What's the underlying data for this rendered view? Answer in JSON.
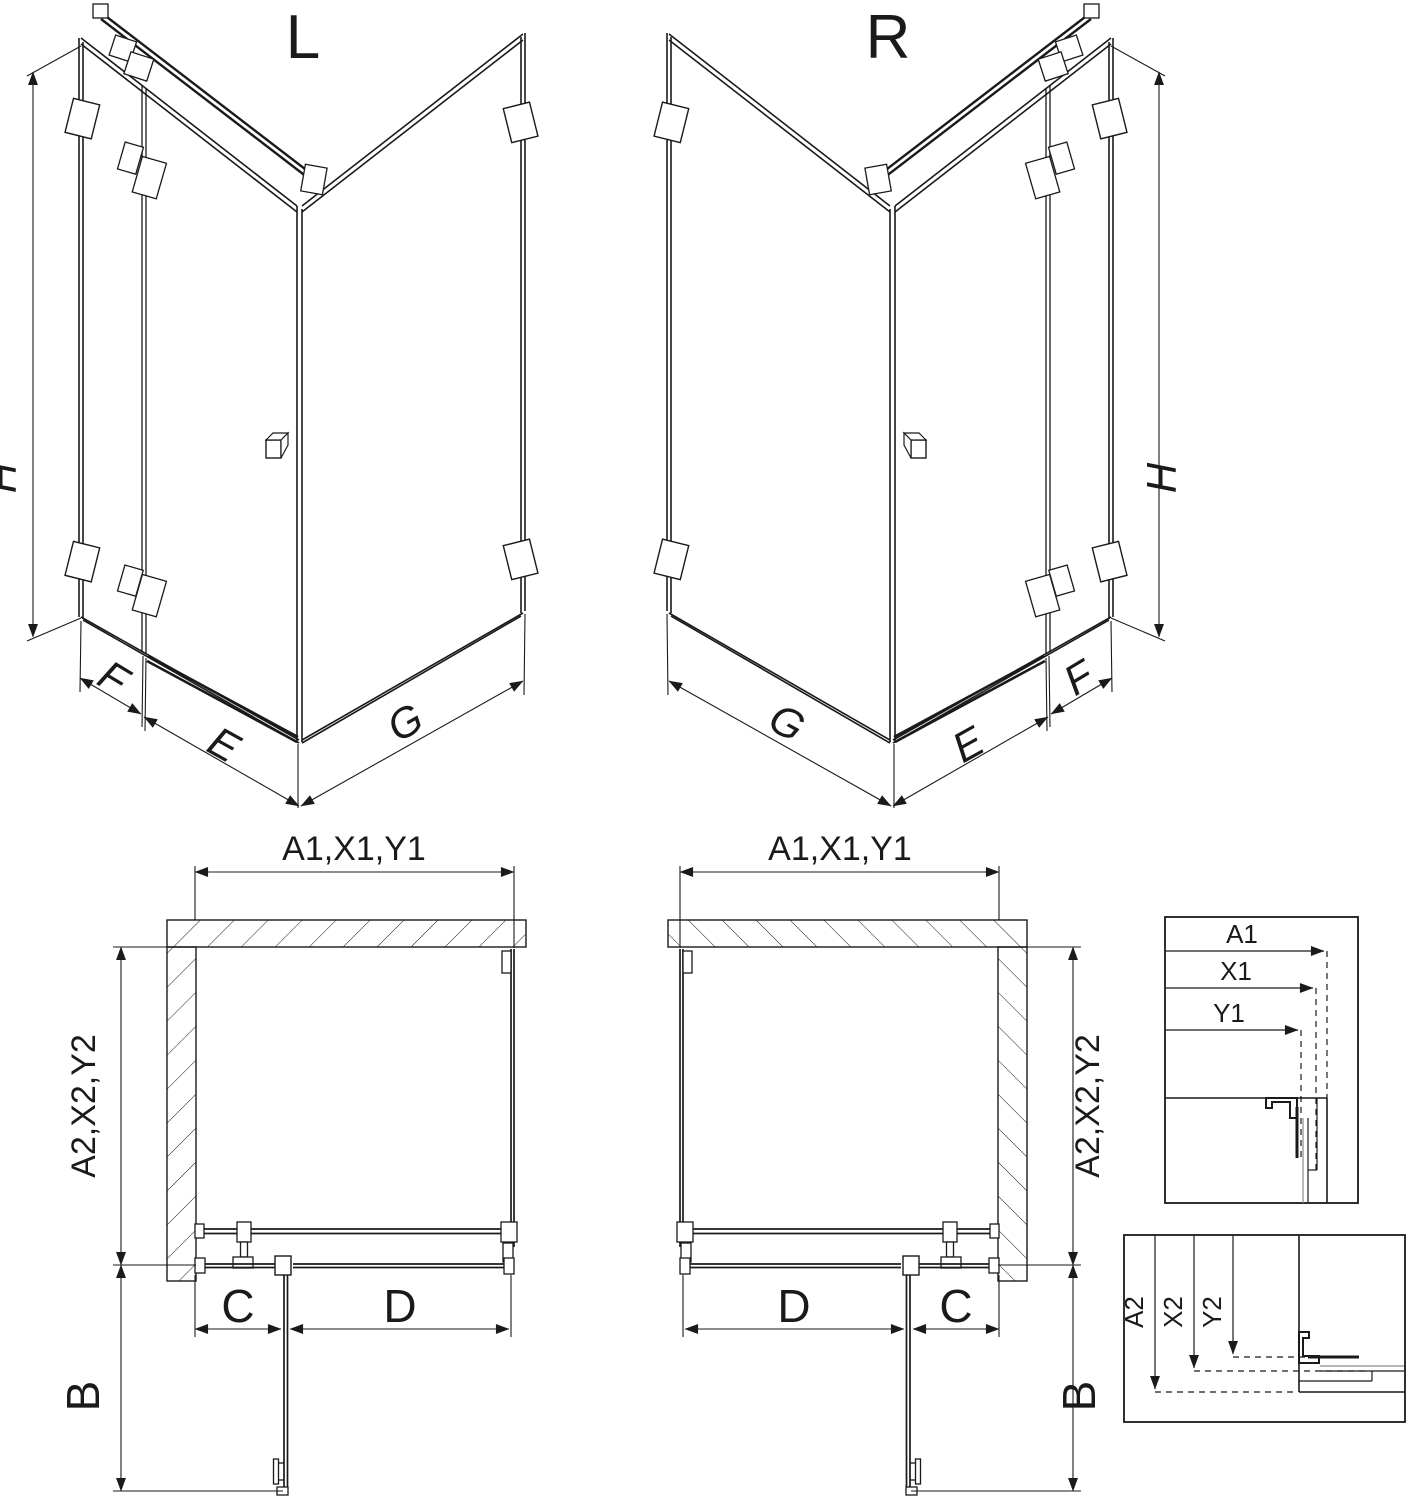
{
  "drawing": {
    "background": "#ffffff",
    "line_color": "#1a1a1a",
    "glass_gray": "#8a8a8a",
    "iso_left": {
      "title": "L",
      "height_label": "H",
      "panel_label": "F",
      "door_label": "E",
      "return_label": "G"
    },
    "iso_right": {
      "title": "R",
      "height_label": "H",
      "panel_label": "F",
      "door_label": "E",
      "return_label": "G"
    },
    "plan_left": {
      "width_label": "A1,X1,Y1",
      "depth_label": "A2,X2,Y2",
      "c_label": "C",
      "d_label": "D",
      "b_label": "B"
    },
    "plan_right": {
      "width_label": "A1,X1,Y1",
      "depth_label": "A2,X2,Y2",
      "c_label": "C",
      "d_label": "D",
      "b_label": "B"
    },
    "detail_width": {
      "a1": "A1",
      "x1": "X1",
      "y1": "Y1"
    },
    "detail_depth": {
      "a2": "A2",
      "x2": "X2",
      "y2": "Y2"
    }
  }
}
